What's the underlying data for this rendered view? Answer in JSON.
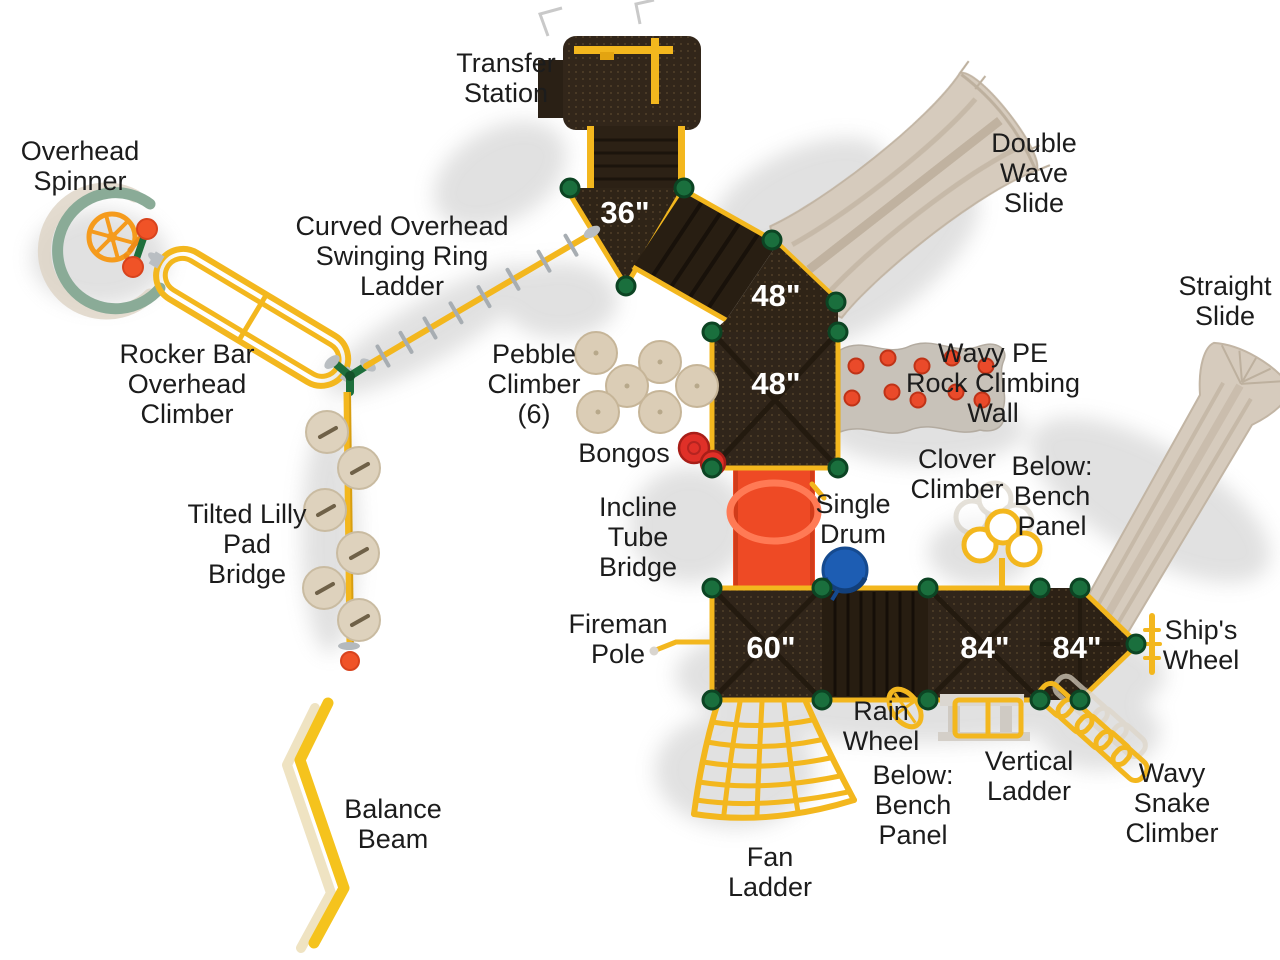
{
  "figure": {
    "type": "playground-equipment-top-view-diagram",
    "background": "#ffffff"
  },
  "palette": {
    "deck_brown": "#30251a",
    "deck_dark": "#271d11",
    "edge_yellow": "#f3b71e",
    "beam_yellow": "#f5c31d",
    "post_green": "#1a6f3d",
    "slide_tan": "#d6cbbd",
    "tube_red": "#ee4a25",
    "rock_wall_gray": "#c8c2b9",
    "rock_red": "#ea4a2a",
    "pebble_tan": "#dbcdb6",
    "drum_blue": "#1d5db3",
    "bongo_red": "#e03028",
    "ball_orange": "#f05327",
    "label_black": "#1c1c1c",
    "shadow_gray": "#b5b5b5"
  },
  "equipment_labels": {
    "transfer_station": "Transfer\nStation",
    "double_wave_slide": "Double\nWave\nSlide",
    "overhead_spinner": "Overhead\nSpinner",
    "curved_overhead_swinging_ring_ladder": "Curved Overhead\nSwinging Ring\nLadder",
    "straight_slide": "Straight\nSlide",
    "rocker_bar_overhead_climber": "Rocker Bar\nOverhead\nClimber",
    "pebble_climber": "Pebble\nClimber\n(6)",
    "wavy_pe_rock_climbing_wall": "Wavy PE\nRock Climbing\nWall",
    "bongos": "Bongos",
    "clover_climber": "Clover\nClimber",
    "below_bench_panel_right": "Below:\nBench\nPanel",
    "single_drum": "Single\nDrum",
    "incline_tube_bridge": "Incline\nTube\nBridge",
    "tilted_lilly_pad_bridge": "Tilted Lilly\nPad\nBridge",
    "fireman_pole": "Fireman\nPole",
    "ships_wheel": "Ship's\nWheel",
    "rain_wheel": "Rain\nWheel",
    "vertical_ladder": "Vertical\nLadder",
    "below_bench_panel_bottom": "Below:\nBench\nPanel",
    "wavy_snake_climber": "Wavy\nSnake\nClimber",
    "balance_beam": "Balance\nBeam",
    "fan_ladder": "Fan\nLadder"
  },
  "deck_labels": {
    "deck_36": "36\"",
    "deck_48_upper": "48\"",
    "deck_48_lower": "48\"",
    "deck_60": "60\"",
    "deck_84_left": "84\"",
    "deck_84_right": "84\""
  }
}
